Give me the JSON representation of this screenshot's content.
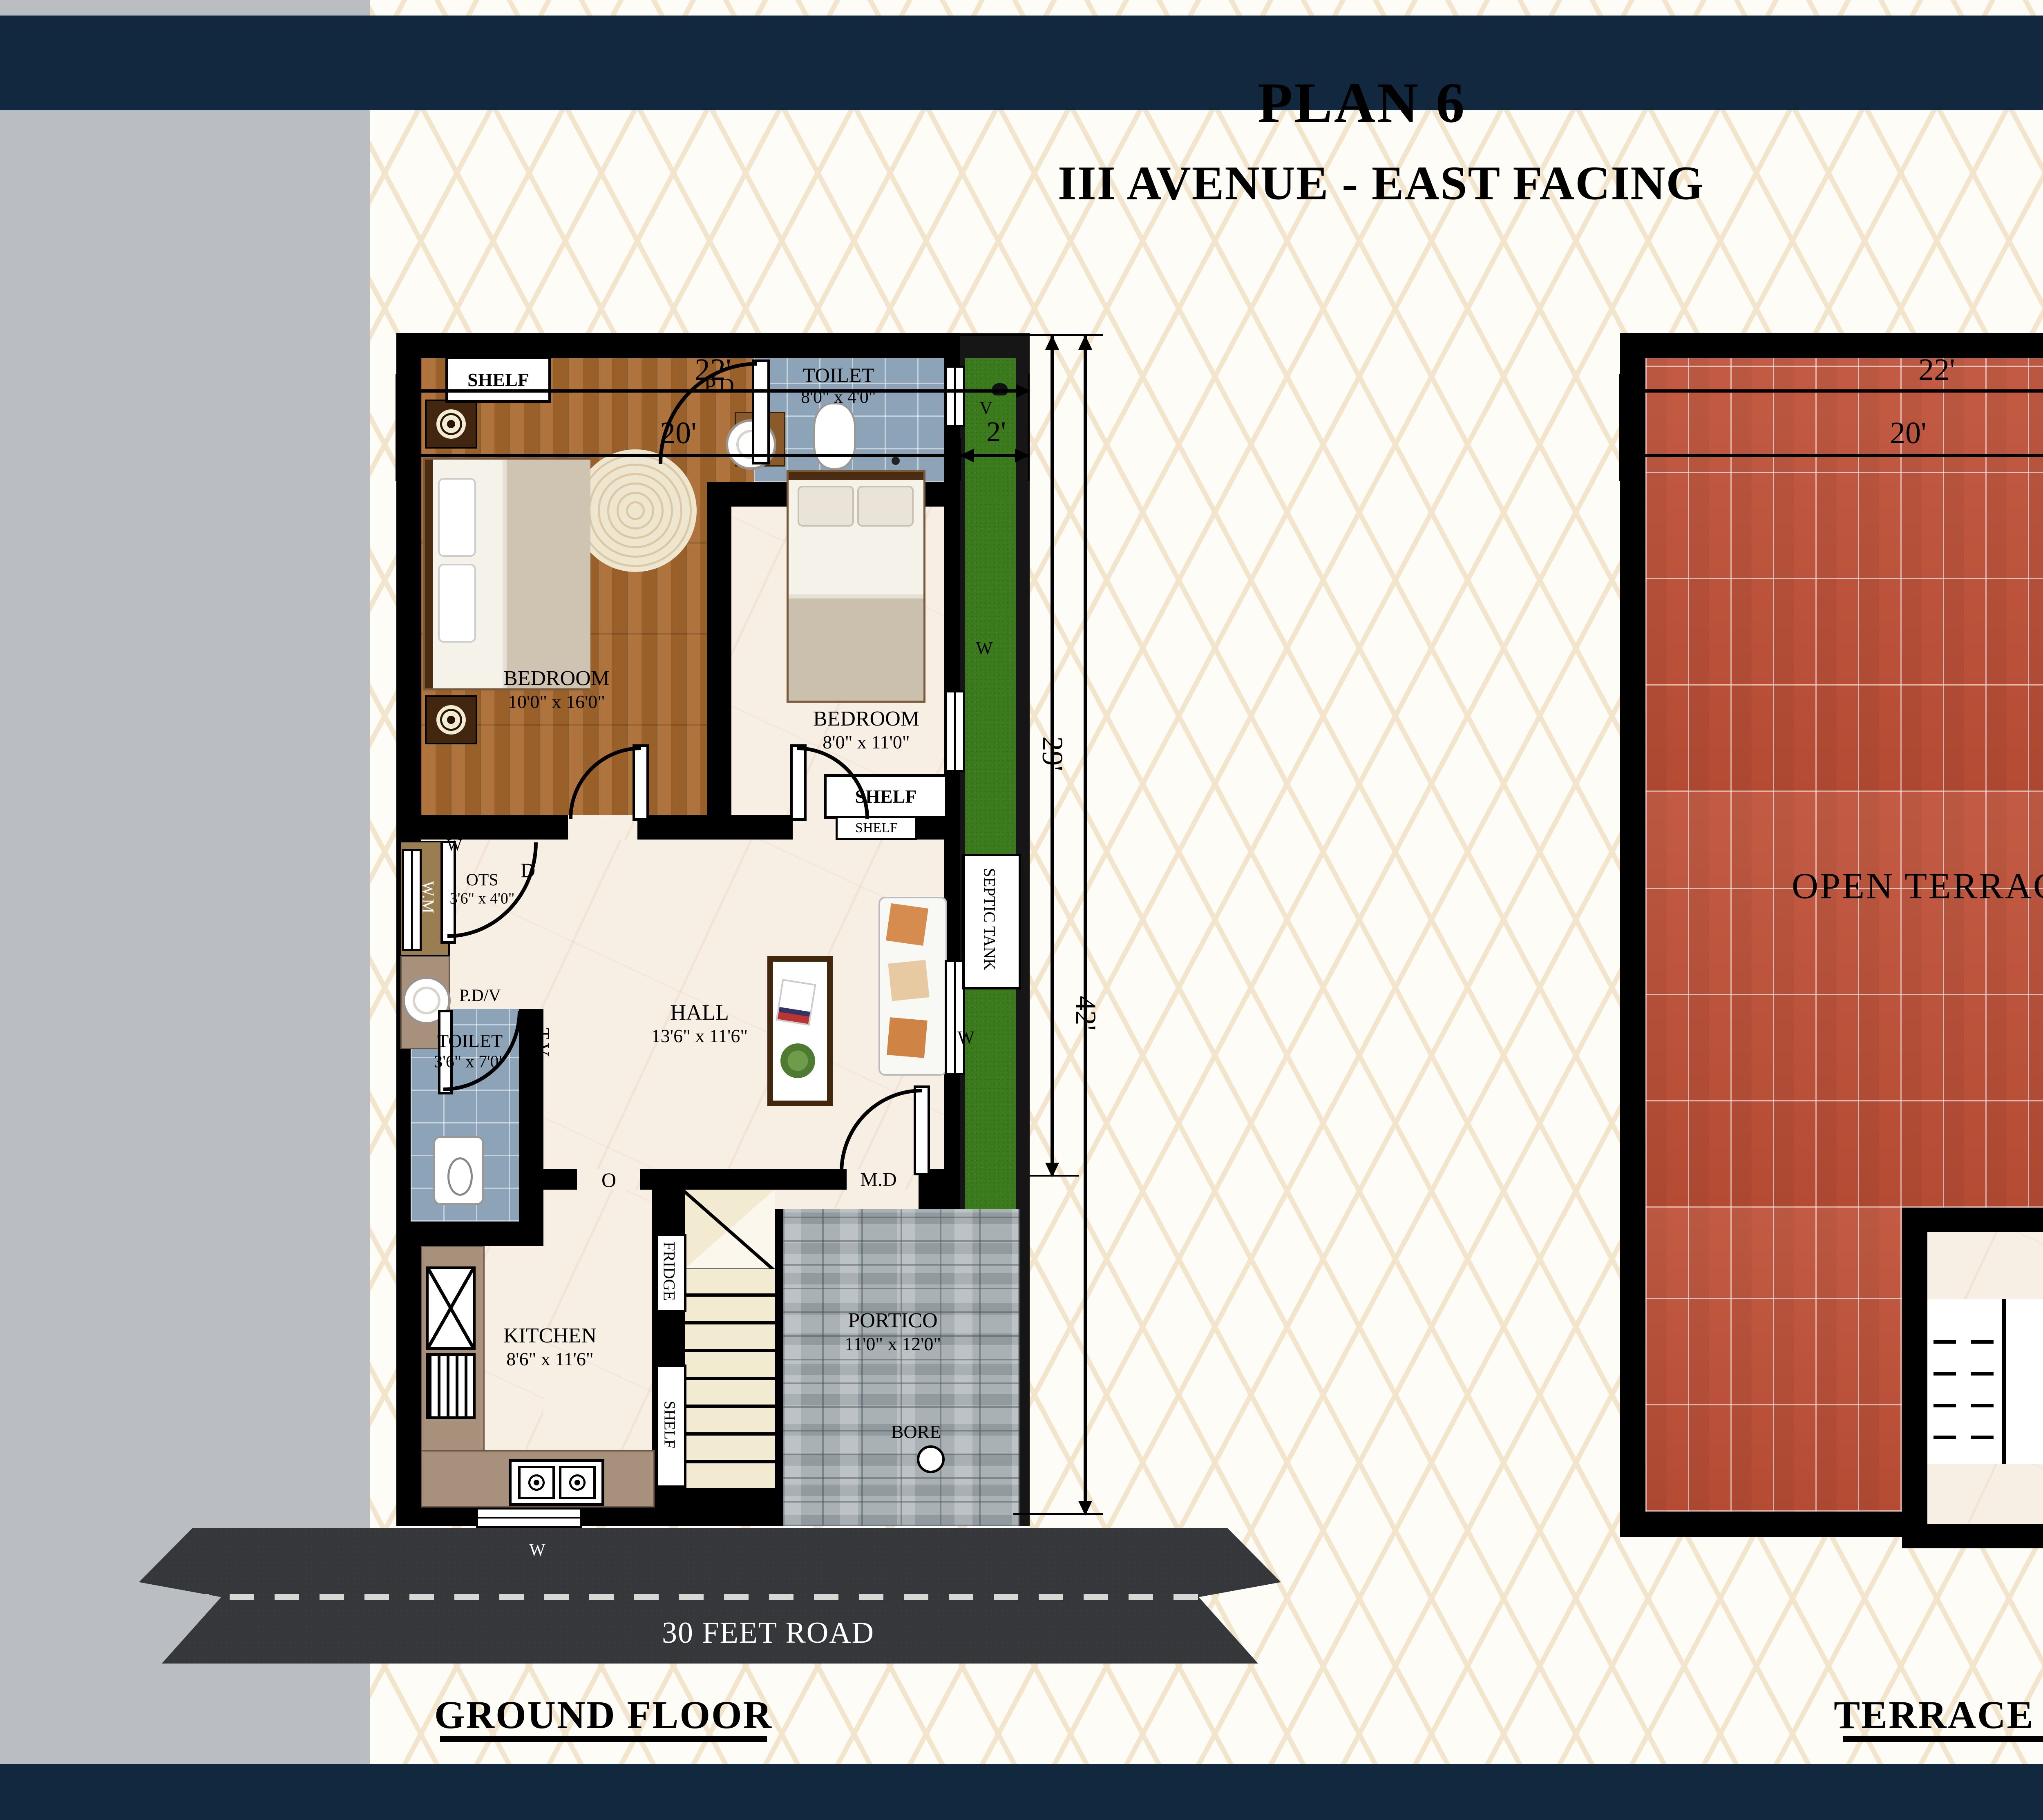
{
  "header": {
    "title": "PLAN 6",
    "subtitle": "III AVENUE - EAST FACING",
    "north_label": "N"
  },
  "ground_floor": {
    "title": "GROUND FLOOR",
    "dims": {
      "total_width": "22'",
      "house_width": "20'",
      "garden_width": "2'",
      "upper_depth": "29'",
      "total_depth": "42'"
    },
    "bedroom1_name": "BEDROOM",
    "bedroom1_size": "10'0\" x 16'0\"",
    "bedroom2_name": "BEDROOM",
    "bedroom2_size": "8'0\" x 11'0\"",
    "toilet1_name": "TOILET",
    "toilet1_size": "8'0\" x 4'0\"",
    "toilet2_name": "TOILET",
    "toilet2_size": "3'6\" x 7'0\"",
    "ots_name": "OTS",
    "ots_size": "3'6\" x 4'0\"",
    "hall_name": "HALL",
    "hall_size": "13'6\" x 11'6\"",
    "kitchen_name": "KITCHEN",
    "kitchen_size": "8'6\" x 11'6\"",
    "portico_name": "PORTICO",
    "portico_size": "11'0\" x 12'0\"",
    "shelf": "SHELF",
    "pd": "P.D",
    "pdv": "P.D/V",
    "wm": "W.M",
    "tv": "T.V",
    "septic_tank": "SEPTIC TANK",
    "fridge": "FRIDGE",
    "bore": "BORE",
    "door": "D",
    "window": "W",
    "ventilator": "V",
    "opening": "O",
    "main_door": "M.D",
    "road": "30 FEET ROAD"
  },
  "terrace_floor": {
    "title": "TERRACE FLOOR",
    "dims": {
      "total_width": "22'",
      "house_width": "20'",
      "garden_width": "2'",
      "depth": "29'"
    },
    "open_terrace": "OPEN TERRACE",
    "grill_door": "G.D"
  },
  "colors": {
    "navy": "#12283f",
    "sidebar_grey": "#babdc1",
    "wall": "#000000",
    "wood": "#a96a2e",
    "marble": "#f7efe4",
    "tile_blue": "#8da3b8",
    "grass": "#3c7a1e",
    "terracotta": "#bf4f36",
    "paver_grey": "#a9b1b5",
    "road_grey": "#35373a",
    "pattern_line": "#f2e5cb"
  }
}
